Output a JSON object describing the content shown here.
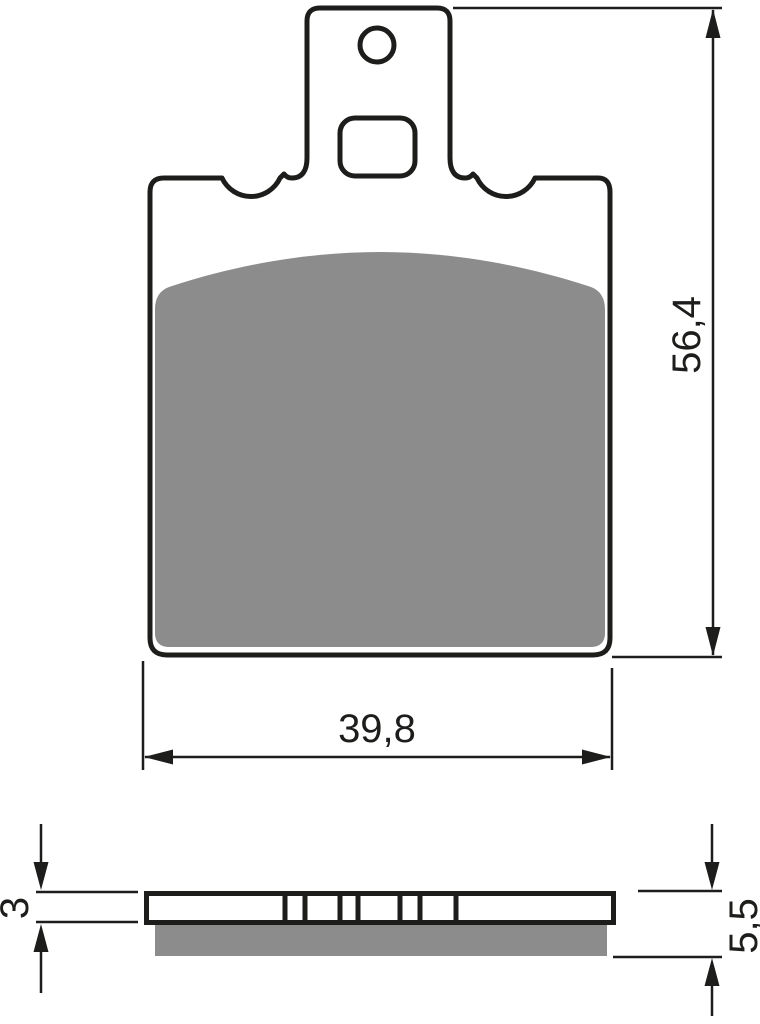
{
  "drawing": {
    "front_view": {
      "height_label": "56,4",
      "width_label": "39,8"
    },
    "side_view": {
      "backplate_thickness_label": "3",
      "total_thickness_label": "5,5"
    },
    "colors": {
      "line": "#1d1d1b",
      "friction_material": "#8c8c8c",
      "background": "#ffffff"
    }
  }
}
